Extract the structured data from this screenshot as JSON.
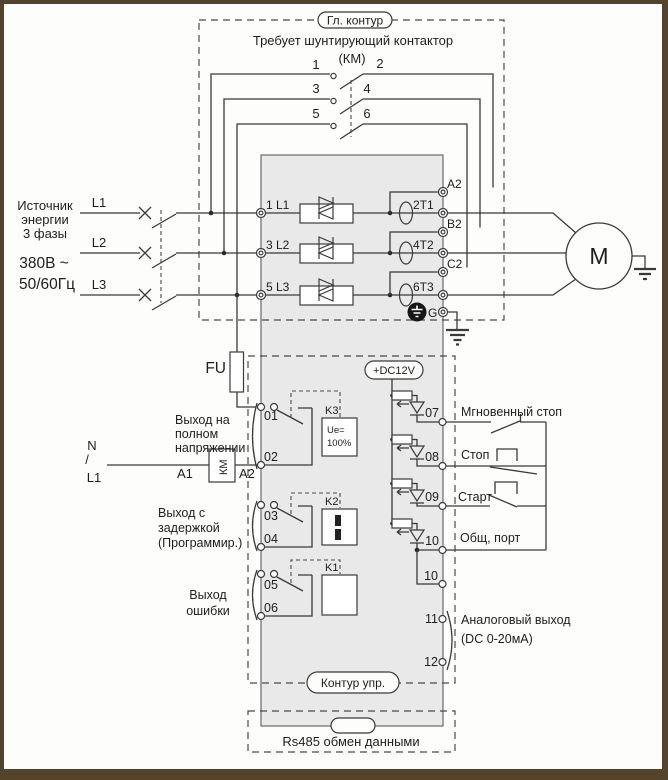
{
  "colors": {
    "frame": "#54432c",
    "line": "#3a3a3a",
    "block_fill": "#e9e9e9",
    "paper": "#fdfdfc"
  },
  "diagram": {
    "main_circuit": {
      "title": "Гл. контур",
      "note": "Требует шунтирующий контактор",
      "note2": "(КМ)",
      "contacts": [
        "1",
        "2",
        "3",
        "4",
        "5",
        "6"
      ]
    },
    "source": {
      "name": [
        "Источник",
        "энергии",
        "3 фазы"
      ],
      "voltage": "380В ~",
      "frequency": "50/60Гц",
      "phases": [
        "L1",
        "L2",
        "L3"
      ]
    },
    "starter": {
      "inputs": [
        "1 L1",
        "3 L2",
        "5 L3"
      ],
      "outputs": [
        "2T1",
        "4T2",
        "6T3"
      ],
      "bypass": [
        "A2",
        "B2",
        "C2"
      ],
      "ground": "G",
      "fuse": "FU",
      "dc": "+DC12V"
    },
    "motor": "M",
    "outputs": {
      "full_voltage": {
        "lines": [
          "Выход на",
          "полном",
          "напряжении"
        ],
        "t": [
          "01",
          "02"
        ],
        "relay": "K3",
        "relay_val": [
          "Ue=",
          "100%"
        ]
      },
      "delayed": {
        "lines": [
          "Выход с",
          "задержкой",
          "(Программир.)"
        ],
        "t": [
          "03",
          "04"
        ],
        "relay": "K2"
      },
      "fault": {
        "lines": [
          "Выход",
          "ошибки"
        ],
        "t": [
          "05",
          "06"
        ],
        "relay": "K1"
      }
    },
    "km": {
      "n": "N",
      "slash": "/",
      "l1": "L1",
      "a1": "A1",
      "a2": "A2",
      "coil": "КМ"
    },
    "inputs": {
      "t": [
        "07",
        "08",
        "09",
        "10"
      ],
      "labels": [
        "Мгновенный стоп",
        "Стоп",
        "Старт",
        "Общ, порт"
      ]
    },
    "analog": {
      "t": [
        "10",
        "11",
        "12"
      ],
      "lines": [
        "Аналоговый выход",
        "(DC 0-20мА)"
      ]
    },
    "control_label": "Контур упр.",
    "rs485": "Rs485 обмен данными"
  }
}
